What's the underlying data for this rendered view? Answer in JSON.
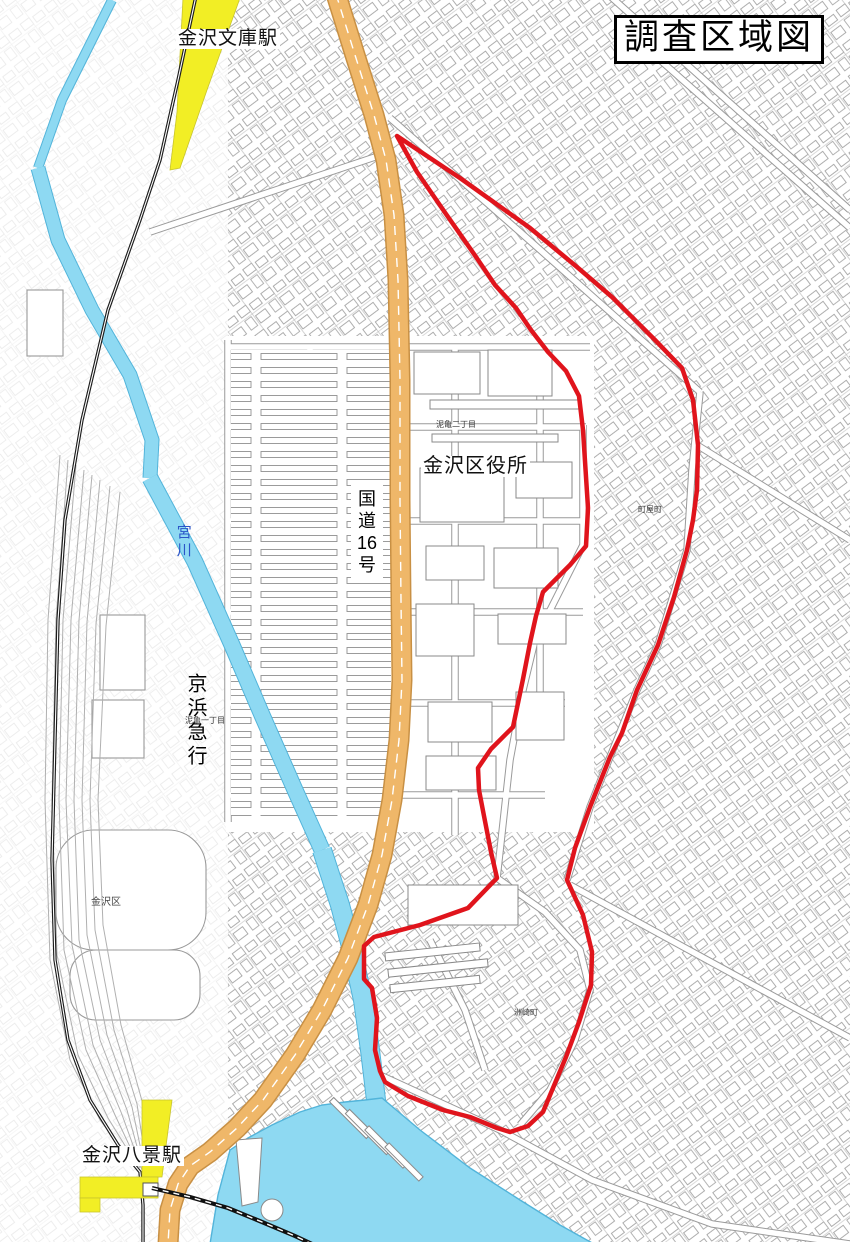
{
  "title": "調査区域図",
  "labels": {
    "kanazawa_bunko_station": "金沢文庫駅",
    "kanazawa_ward_office": "金沢区役所",
    "route16_char1": "国",
    "route16_char2": "道",
    "route16_char3": "16",
    "route16_char4": "号",
    "keihin_kyuko": "京浜急行",
    "miyagawa_river": "宮川",
    "kanazawa_hakkei_station": "金沢八景駅",
    "kanazawa_ku": "金沢区",
    "deiki_2chome": "泥亀二丁目",
    "deiki_1chome": "泥亀一丁目",
    "machiya_cho": "町屋町",
    "susaki_cho": "洲崎町"
  },
  "colors": {
    "boundary_red": "#e0141c",
    "road_orange": "#efb769",
    "road_orange_edge": "#c89044",
    "water_blue": "#8ed9f2",
    "water_edge": "#52b4da",
    "rail_yellow": "#f2ee25",
    "fabric_gray": "#9a9a9a",
    "river_label_blue": "#2b55c8"
  }
}
